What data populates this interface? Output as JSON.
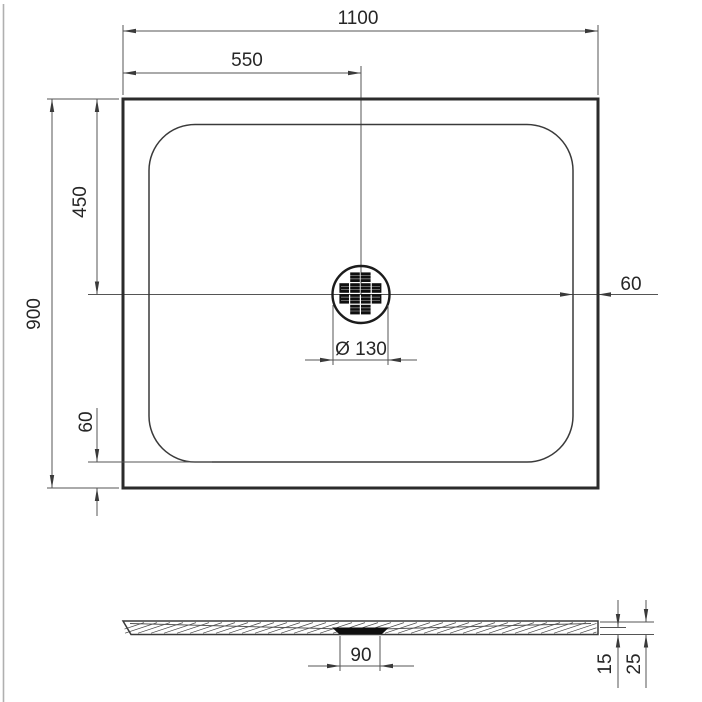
{
  "top_view": {
    "dims": {
      "overall_width": "1100",
      "half_width": "550",
      "overall_depth": "900",
      "half_depth": "450",
      "rim_right": "60",
      "rim_bottom": "60",
      "drain_diameter": "Ø 130"
    }
  },
  "side_view": {
    "dims": {
      "drain_width": "90",
      "rim_height": "15",
      "total_height": "25"
    }
  }
}
